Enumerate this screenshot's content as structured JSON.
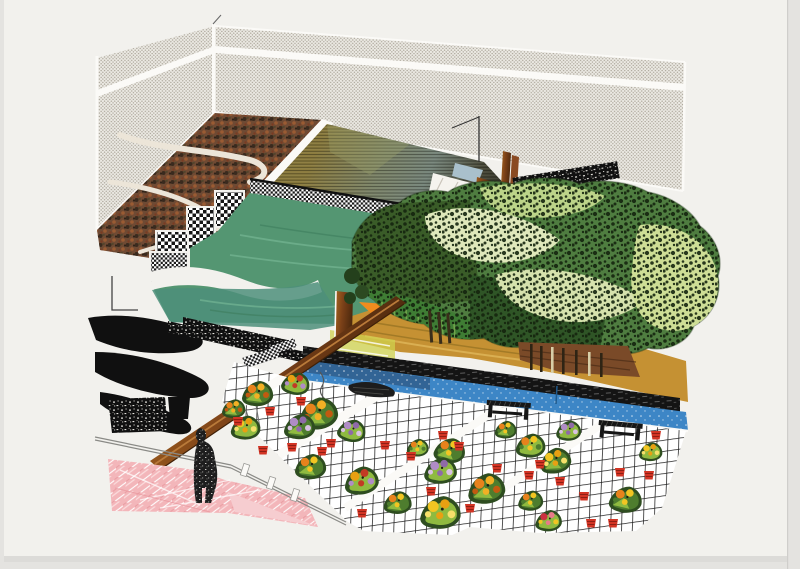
{
  "palette": {
    "backdrop": "#e4e3e0",
    "paper": "#f2f1ed",
    "paper_bright": "#fbfaf7",
    "shadow": "#dcdbd8",
    "fence_bg": "#edebe5",
    "fence_dot": "#aca69a",
    "hill_base": "#6f4a33",
    "hill_dark": "#3a2a1e",
    "hill_rust": "#9a5b33",
    "path_cream": "#ece5d8",
    "pool_gold": "#8a7a3c",
    "pool_green": "#76857b",
    "pool_dark": "#262620",
    "lawn": "#549672",
    "lawn_deep": "#4e8f7a",
    "lawn_streak": "#7ec09c",
    "checker_dark": "#161616",
    "tree_base": "#4f7d40",
    "tree_dark": "#3a5c28",
    "tree_darker": "#2f5526",
    "tree_light": "#dfe8bb",
    "tree_lime": "#cede96",
    "grass_stroke": "#7fae52",
    "ochre": "#c59133",
    "ochre_dark": "#8a6a1e",
    "soil": "#7a4a28",
    "trunk": "#2f2414",
    "orange_wedge": "#f08c1e",
    "rail_light": "#a8661f",
    "rail_mid": "#7a4018",
    "rail_dark": "#4f2a0e",
    "hedge_black": "#141414",
    "water_blue": "#3d86c6",
    "water_navy": "#31618f",
    "grid_line": "#1b1b1b",
    "pink": "#f3b6ba",
    "pink_light": "#f6cdd0",
    "pot_red": "#d23424",
    "pot_dark": "#8f1f14",
    "bench_black": "#161616",
    "figure": "#1e1e1e",
    "noise_bg": "#101010",
    "deck_blue": "#a9c0cc"
  },
  "flowers": {
    "yellow": [
      "#f2c522",
      "#e8a012",
      "#f6e06a"
    ],
    "orange": [
      "#e8821c",
      "#f2b024",
      "#c25a10"
    ],
    "purple": [
      "#b08cc6",
      "#8f6aa8",
      "#d8c2e2"
    ],
    "mixed": [
      "#e8a012",
      "#c23a24",
      "#b08cc6"
    ],
    "green": [
      "#e8821c",
      "#f2c522",
      "#4e7d2e"
    ],
    "red": [
      "#cc3040",
      "#e87a8a",
      "#f2c522"
    ]
  },
  "leaf_colors": [
    "#2e4d20",
    "#4e7d2e",
    "#8fba40"
  ],
  "patio": {
    "bouquets": [
      {
        "x": 258,
        "y": 394,
        "t": "orange",
        "s": 1.0,
        "r": 0
      },
      {
        "x": 296,
        "y": 384,
        "t": "mixed",
        "s": 0.9,
        "r": 10
      },
      {
        "x": 319,
        "y": 414,
        "t": "orange",
        "s": 1.25,
        "r": -8
      },
      {
        "x": 246,
        "y": 428,
        "t": "yellow",
        "s": 0.95,
        "r": 0
      },
      {
        "x": 300,
        "y": 427,
        "t": "purple",
        "s": 1.0,
        "r": 0
      },
      {
        "x": 352,
        "y": 431,
        "t": "purple",
        "s": 0.9,
        "r": 12
      },
      {
        "x": 311,
        "y": 467,
        "t": "green",
        "s": 1.0,
        "r": 0
      },
      {
        "x": 362,
        "y": 481,
        "t": "mixed",
        "s": 1.1,
        "r": -6
      },
      {
        "x": 450,
        "y": 451,
        "t": "green",
        "s": 1.0,
        "r": 8
      },
      {
        "x": 441,
        "y": 471,
        "t": "purple",
        "s": 1.05,
        "r": 0
      },
      {
        "x": 487,
        "y": 489,
        "t": "orange",
        "s": 1.2,
        "r": -5
      },
      {
        "x": 441,
        "y": 513,
        "t": "yellow",
        "s": 1.3,
        "r": 0
      },
      {
        "x": 398,
        "y": 503,
        "t": "green",
        "s": 0.9,
        "r": 0
      },
      {
        "x": 531,
        "y": 446,
        "t": "green",
        "s": 0.95,
        "r": 0
      },
      {
        "x": 556,
        "y": 461,
        "t": "yellow",
        "s": 1.0,
        "r": -10
      },
      {
        "x": 569,
        "y": 431,
        "t": "purple",
        "s": 0.8,
        "r": 0
      },
      {
        "x": 531,
        "y": 501,
        "t": "green",
        "s": 0.8,
        "r": 0
      },
      {
        "x": 549,
        "y": 521,
        "t": "red",
        "s": 0.85,
        "r": 0
      },
      {
        "x": 626,
        "y": 500,
        "t": "green",
        "s": 1.05,
        "r": 6
      },
      {
        "x": 651,
        "y": 452,
        "t": "yellow",
        "s": 0.75,
        "r": 0
      },
      {
        "x": 234,
        "y": 409,
        "t": "orange",
        "s": 0.75,
        "r": 0
      },
      {
        "x": 418,
        "y": 448,
        "t": "green",
        "s": 0.7,
        "r": 0
      },
      {
        "x": 506,
        "y": 430,
        "t": "green",
        "s": 0.7,
        "r": 0
      }
    ],
    "pots": [
      [
        270,
        407
      ],
      [
        301,
        397
      ],
      [
        331,
        439
      ],
      [
        292,
        443
      ],
      [
        263,
        446
      ],
      [
        385,
        441
      ],
      [
        411,
        452
      ],
      [
        431,
        487
      ],
      [
        497,
        464
      ],
      [
        529,
        471
      ],
      [
        560,
        477
      ],
      [
        591,
        519
      ],
      [
        613,
        519
      ],
      [
        649,
        471
      ],
      [
        656,
        431
      ],
      [
        443,
        431
      ],
      [
        470,
        504
      ],
      [
        362,
        509
      ],
      [
        238,
        417
      ],
      [
        322,
        447
      ],
      [
        459,
        442
      ],
      [
        540,
        460
      ],
      [
        584,
        492
      ],
      [
        620,
        468
      ]
    ],
    "benches": [
      {
        "x": 487,
        "y": 400,
        "w": 44,
        "rot": 4,
        "blob": false
      },
      {
        "x": 599,
        "y": 420,
        "w": 44,
        "rot": 5,
        "blob": false
      },
      {
        "x": 350,
        "y": 379,
        "w": 50,
        "rot": 7,
        "blob": true
      }
    ]
  }
}
